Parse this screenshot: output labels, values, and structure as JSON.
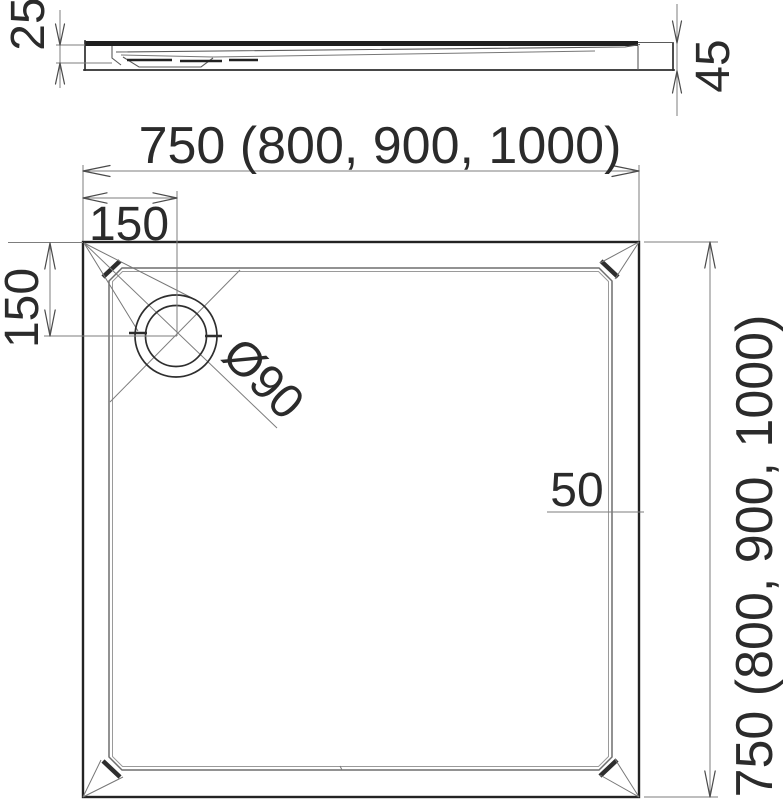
{
  "drawing": {
    "type": "technical-dimension-drawing",
    "background_color": "#ffffff",
    "line_color": "#2e2e2e",
    "text_color": "#2b2b2b",
    "views": {
      "side_profile": {
        "labels": {
          "thickness_left": "25",
          "height_right": "45"
        }
      },
      "plan": {
        "labels": {
          "width_top": "750 (800, 900, 1000)",
          "height_right": "750 (800, 900, 1000)",
          "drain_offset_horizontal": "150",
          "drain_offset_vertical": "150",
          "drain_diameter": "Ø90",
          "edge_offset": "50"
        }
      }
    }
  }
}
